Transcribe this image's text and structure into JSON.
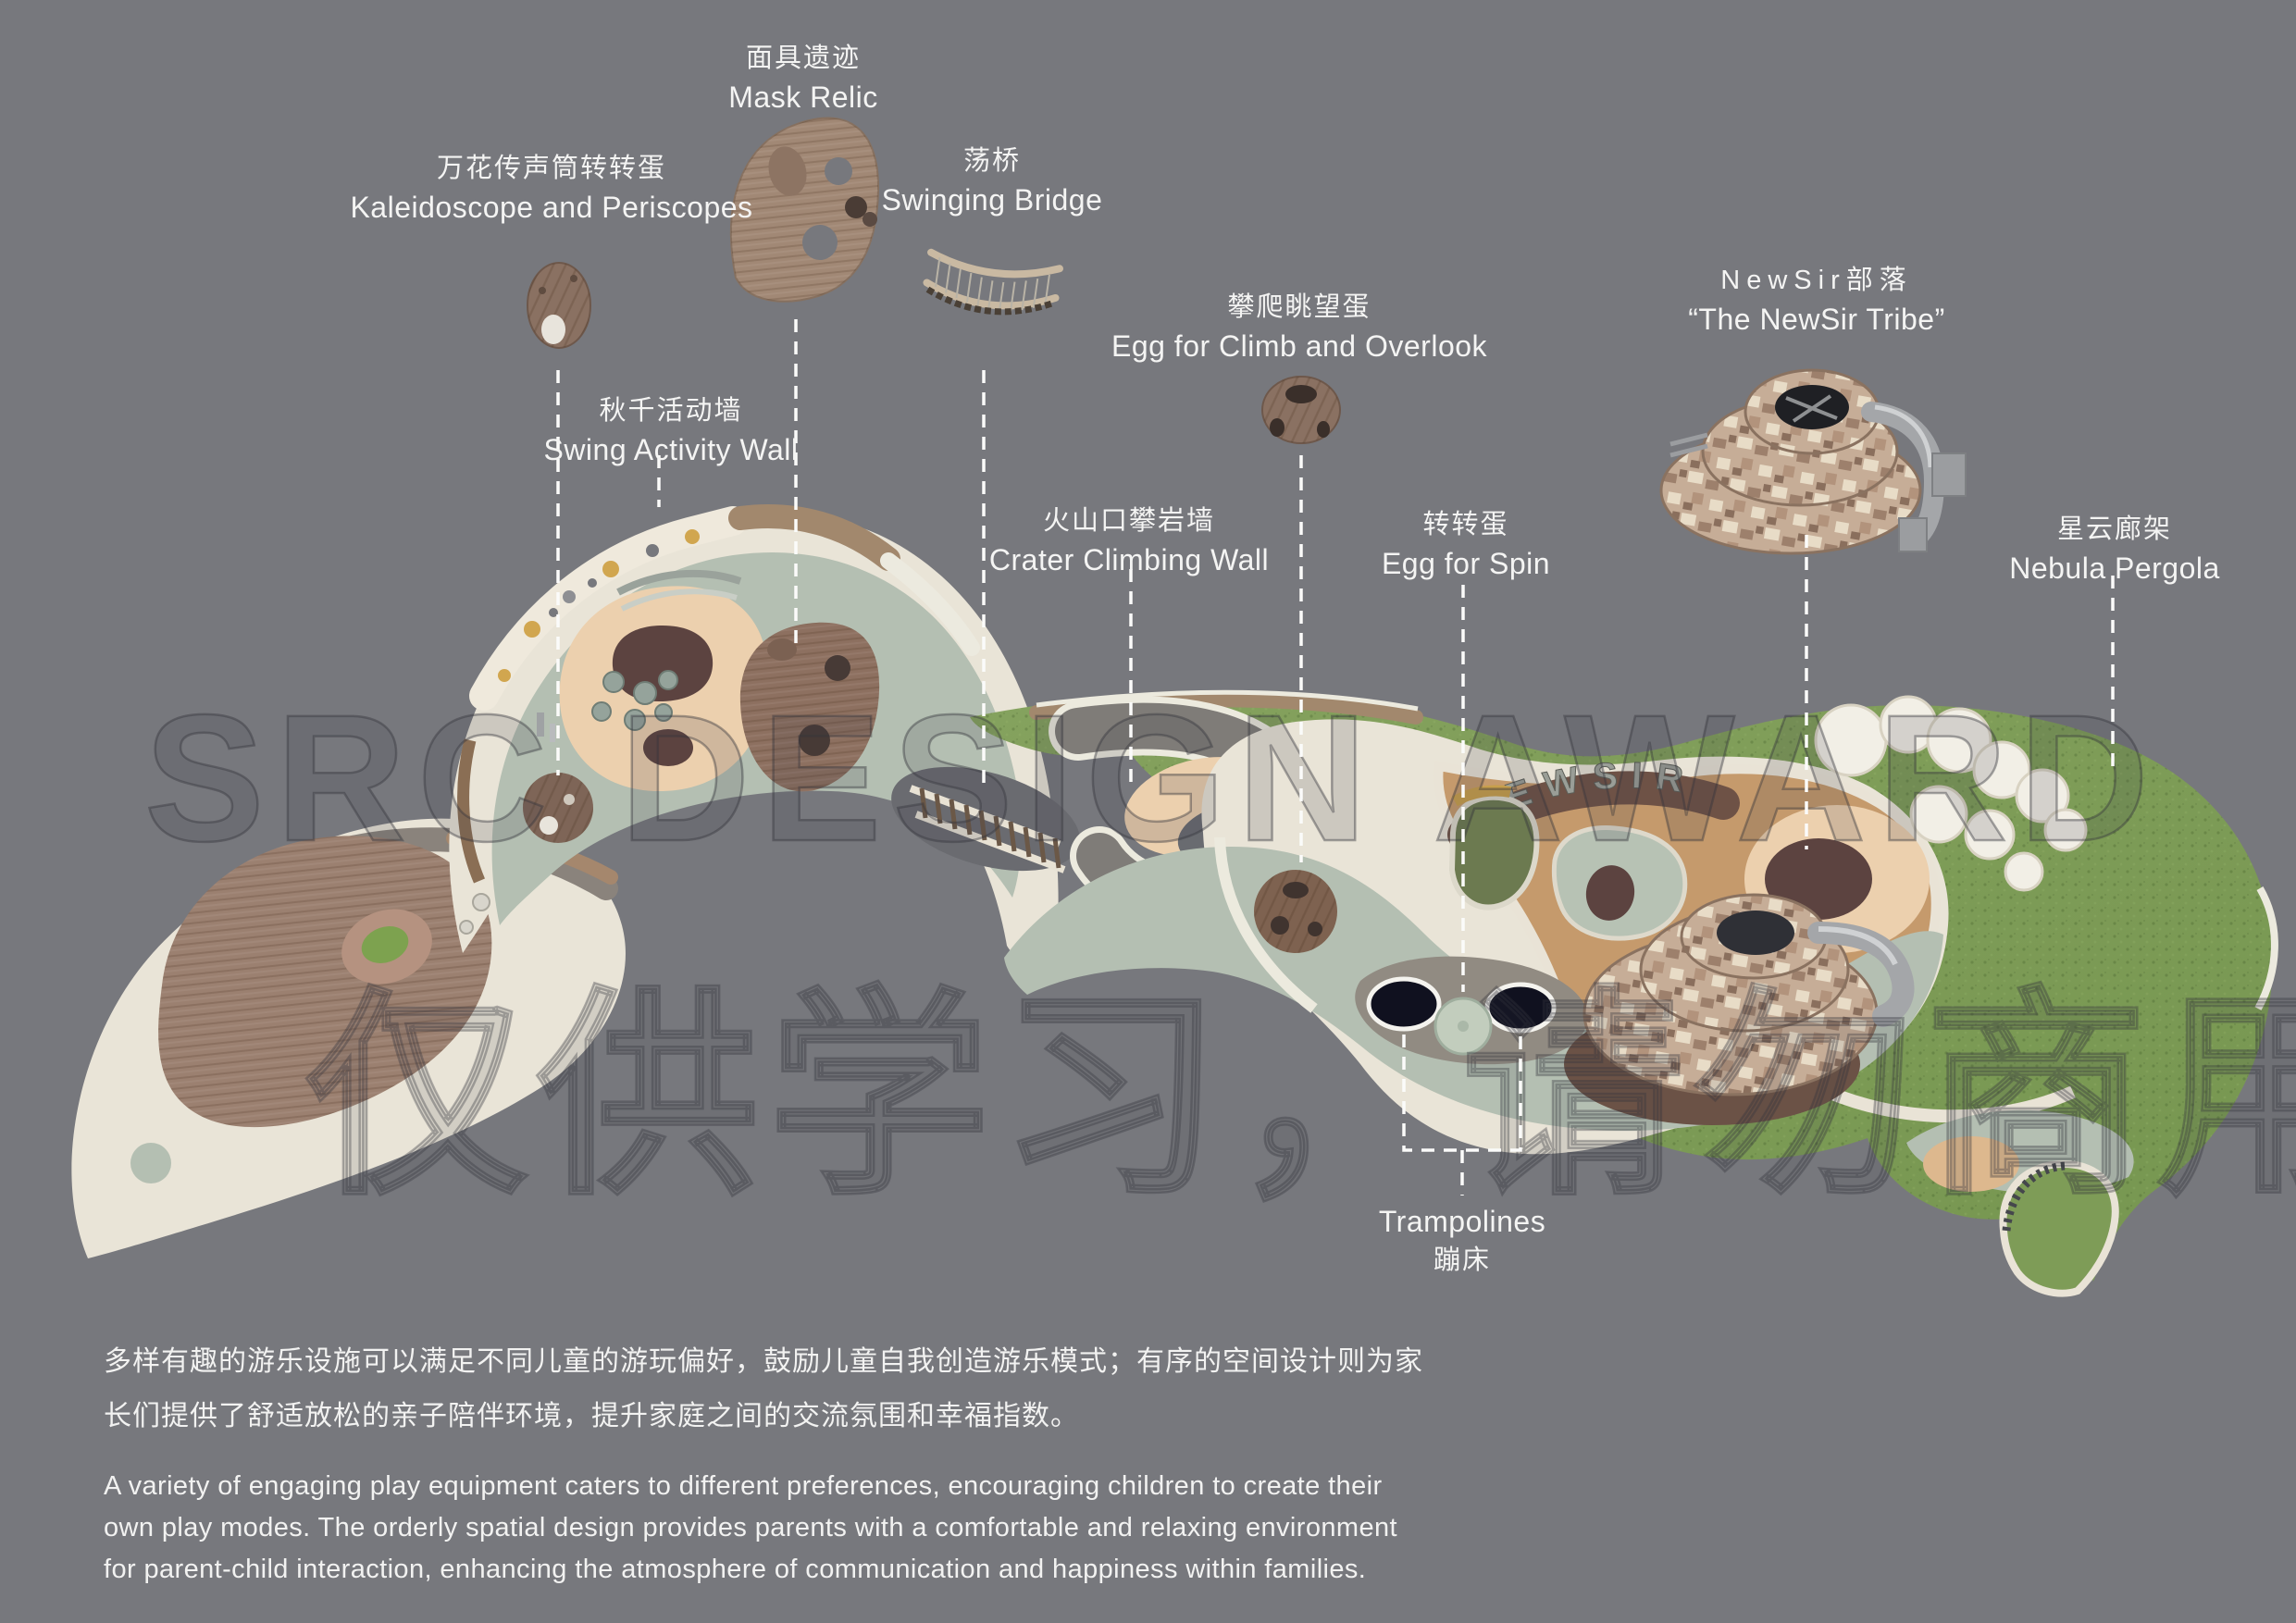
{
  "page": {
    "background": "#77787d"
  },
  "watermark": {
    "title": "SRC DESIGN AWARD",
    "notice": "仅供学习，请勿商用"
  },
  "plan": {
    "newsir_sign": "NEWSIR"
  },
  "callouts": [
    {
      "id": "kaleidoscope",
      "zh": "万花传声筒转转蛋",
      "en": "Kaleidoscope and Periscopes"
    },
    {
      "id": "mask-relic",
      "zh": "面具遗迹",
      "en": "Mask Relic"
    },
    {
      "id": "swinging-bridge",
      "zh": "荡桥",
      "en": "Swinging Bridge"
    },
    {
      "id": "egg-climb",
      "zh": "攀爬眺望蛋",
      "en": "Egg for Climb and Overlook"
    },
    {
      "id": "newsir-tribe",
      "zh": "NewSir部落",
      "en": "“The NewSir Tribe”"
    },
    {
      "id": "swing-wall",
      "zh": "秋千活动墙",
      "en": "Swing Activity Wall"
    },
    {
      "id": "crater-wall",
      "zh": "火山口攀岩墙",
      "en": "Crater Climbing Wall"
    },
    {
      "id": "egg-spin",
      "zh": "转转蛋",
      "en": "Egg for Spin"
    },
    {
      "id": "nebula-pergola",
      "zh": "星云廊架",
      "en": "Nebula Pergola"
    },
    {
      "id": "trampolines",
      "en": "Trampolines",
      "zh": "蹦床"
    }
  ],
  "description": {
    "zh_lines": [
      "多样有趣的游乐设施可以满足不同儿童的游玩偏好，鼓励儿童自我创造游乐模式；有序的空间设计则为家",
      "长们提供了舒适放松的亲子陪伴环境，提升家庭之间的交流氛围和幸福指数。"
    ],
    "en_lines": [
      "A variety of engaging play equipment caters to different preferences, encouraging children to create their",
      "own play modes. The orderly spatial design provides parents with a comfortable and relaxing environment",
      "for parent-child interaction, enhancing the atmosphere of communication and happiness within families."
    ]
  },
  "colors": {
    "background": "#77787d",
    "plan_base_cream": "#e9e4d7",
    "sage": "#b4bfb2",
    "peach": "#ecd0ae",
    "tan": "#c59a6c",
    "grass": "#7e9c57",
    "wood": "#9b8070",
    "dark_brown": "#5c4340",
    "road_taupe": "#8a837c",
    "slide_gray": "#a4a6a9",
    "trampoline_navy": "#10111f",
    "label_text": "#f4f4f3"
  }
}
